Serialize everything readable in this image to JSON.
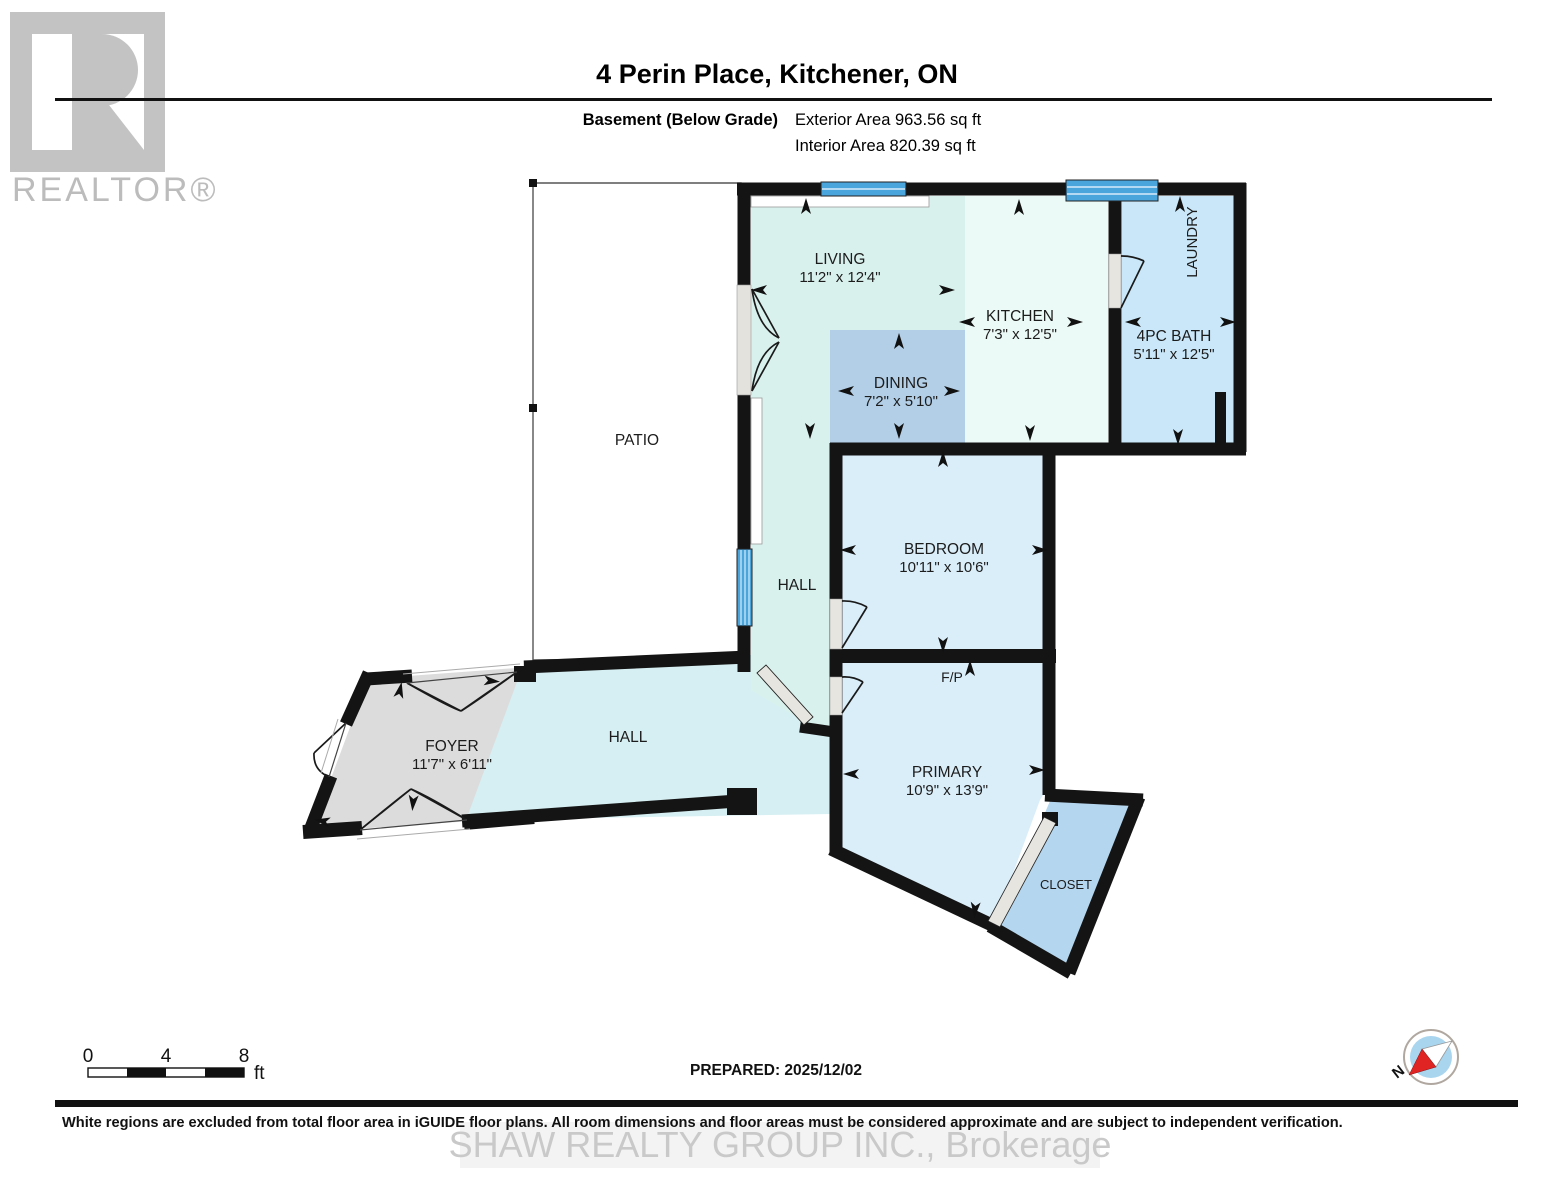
{
  "logo": {
    "brand": "REALTOR®"
  },
  "header": {
    "title": "4 Perin Place, Kitchener, ON",
    "floor_label": "Basement (Below Grade)",
    "exterior_area": "Exterior Area 963.56 sq ft",
    "interior_area": "Interior Area 820.39 sq ft"
  },
  "rooms": {
    "living": {
      "name": "LIVING",
      "dims": "11'2\" x 12'4\""
    },
    "kitchen": {
      "name": "KITCHEN",
      "dims": "7'3\" x 12'5\""
    },
    "dining": {
      "name": "DINING",
      "dims": "7'2\" x 5'10\""
    },
    "bath": {
      "name": "4PC BATH",
      "dims": "5'11\" x 12'5\""
    },
    "laundry": {
      "name": "LAUNDRY"
    },
    "bedroom": {
      "name": "BEDROOM",
      "dims": "10'11\" x 10'6\""
    },
    "primary": {
      "name": "PRIMARY",
      "dims": "10'9\" x 13'9\""
    },
    "fireplace": {
      "name": "F/P"
    },
    "closet": {
      "name": "CLOSET"
    },
    "foyer": {
      "name": "FOYER",
      "dims": "11'7\" x 6'11\""
    },
    "hall_main": {
      "name": "HALL"
    },
    "hall_upper": {
      "name": "HALL"
    },
    "patio": {
      "name": "PATIO"
    }
  },
  "scale_bar": {
    "ticks": [
      "0",
      "4",
      "8"
    ],
    "unit": "ft"
  },
  "prepared_label": "PREPARED: 2025/12/02",
  "compass": {
    "north_label": "N"
  },
  "footer": {
    "disclaimer": "White regions are excluded from total floor area in iGUIDE floor plans. All room dimensions and floor areas must be considered approximate and are subject to independent verification.",
    "watermark": "SHAW REALTY GROUP INC., Brokerage"
  },
  "colors": {
    "wall": "#141414",
    "living_fill": "#d9f1ed",
    "kitchen_fill": "#ecfaf7",
    "dining_fill": "#b2cfe7",
    "bath_fill": "#c9e7f8",
    "bedroom_fill": "#daeefa",
    "closet_fill": "#b4d6ee",
    "foyer_fill": "#dcdcdc",
    "hall_fill": "#d6eff2",
    "window_blue": "#4ba5dd",
    "compass_red": "#e02424",
    "compass_blue": "#a9d5ef"
  }
}
